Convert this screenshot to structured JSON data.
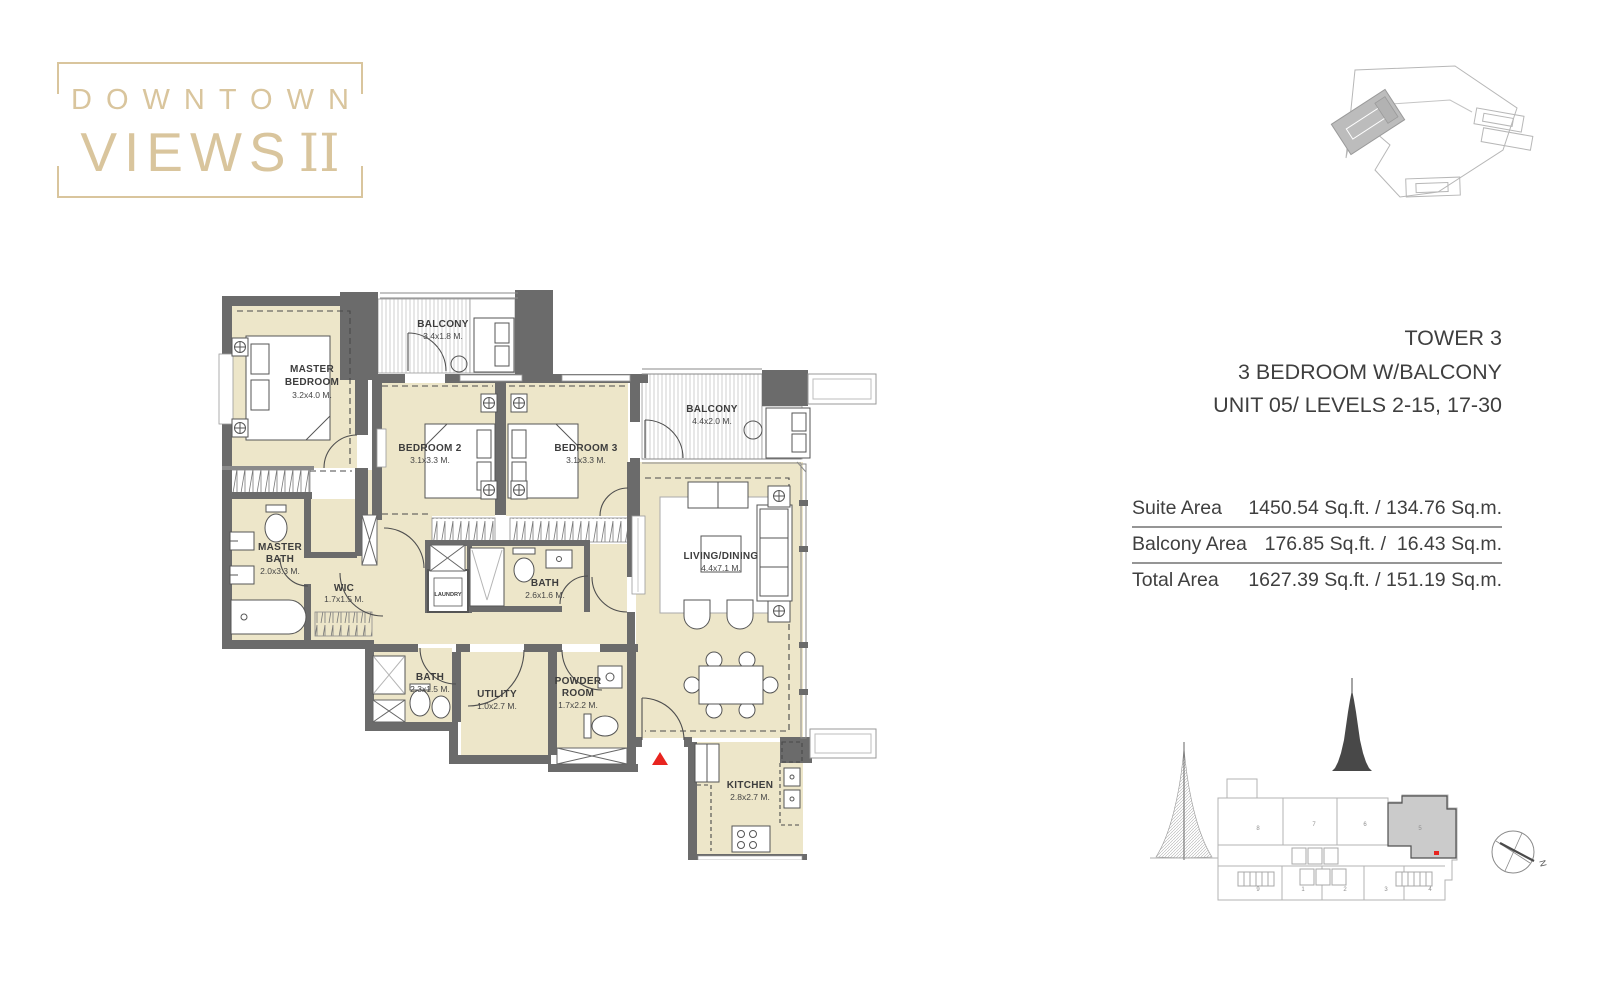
{
  "logo": {
    "line1": "DOWNTOWN",
    "line2": "VIEWS",
    "numeral": "II"
  },
  "unit_info": {
    "lines": [
      "TOWER 3",
      "3 BEDROOM W/BALCONY",
      "UNIT 05/ LEVELS 2-15, 17-30"
    ]
  },
  "area_table": {
    "rows": [
      {
        "label": "Suite Area",
        "value": "1450.54 Sq.ft. / 134.76 Sq.m."
      },
      {
        "label": "Balcony Area",
        "value": "176.85 Sq.ft. /  16.43 Sq.m."
      },
      {
        "label": "Total Area",
        "value": "1627.39 Sq.ft. / 151.19 Sq.m."
      }
    ]
  },
  "floor_plan": {
    "rooms": [
      {
        "id": "master-bedroom",
        "lines": [
          "MASTER",
          "BEDROOM"
        ],
        "dims": "3.2x4.0 M."
      },
      {
        "id": "balcony-1",
        "lines": [
          "BALCONY"
        ],
        "dims": "3.4x1.8 M."
      },
      {
        "id": "bedroom-2",
        "lines": [
          "BEDROOM 2"
        ],
        "dims": "3.1x3.3 M."
      },
      {
        "id": "bedroom-3",
        "lines": [
          "BEDROOM 3"
        ],
        "dims": "3.1x3.3 M."
      },
      {
        "id": "balcony-2",
        "lines": [
          "BALCONY"
        ],
        "dims": "4.4x2.0 M."
      },
      {
        "id": "living-dining",
        "lines": [
          "LIVING/DINING"
        ],
        "dims": "4.4x7.1 M."
      },
      {
        "id": "master-bath",
        "lines": [
          "MASTER",
          "BATH"
        ],
        "dims": "2.0x3.3 M."
      },
      {
        "id": "wic",
        "lines": [
          "WIC"
        ],
        "dims": "1.7x1.5 M."
      },
      {
        "id": "laundry",
        "lines": [
          "LAUNDRY"
        ],
        "dims": ""
      },
      {
        "id": "bath-1",
        "lines": [
          "BATH"
        ],
        "dims": "2.6x1.6 M."
      },
      {
        "id": "bath-2",
        "lines": [
          "BATH"
        ],
        "dims": "2.3x1.5 M."
      },
      {
        "id": "utility",
        "lines": [
          "UTILITY"
        ],
        "dims": "1.0x2.7 M."
      },
      {
        "id": "powder-room",
        "lines": [
          "POWDER",
          "ROOM"
        ],
        "dims": "1.7x2.2 M."
      },
      {
        "id": "kitchen",
        "lines": [
          "KITCHEN"
        ],
        "dims": "2.8x2.7 M."
      }
    ]
  },
  "key_plan": {
    "top_units": [
      "8",
      "7",
      "6",
      "5"
    ],
    "bottom_units": [
      "9",
      "1",
      "2",
      "3",
      "4"
    ],
    "highlighted_unit": "5"
  },
  "compass": {
    "north_label": "N"
  },
  "colors": {
    "accent_gold": "#D9C59D",
    "wall_gray": "#6B6B6B",
    "room_cream": "#EDE6C9",
    "highlight_red": "#E8241F",
    "text_dark": "#3D3D3D"
  }
}
